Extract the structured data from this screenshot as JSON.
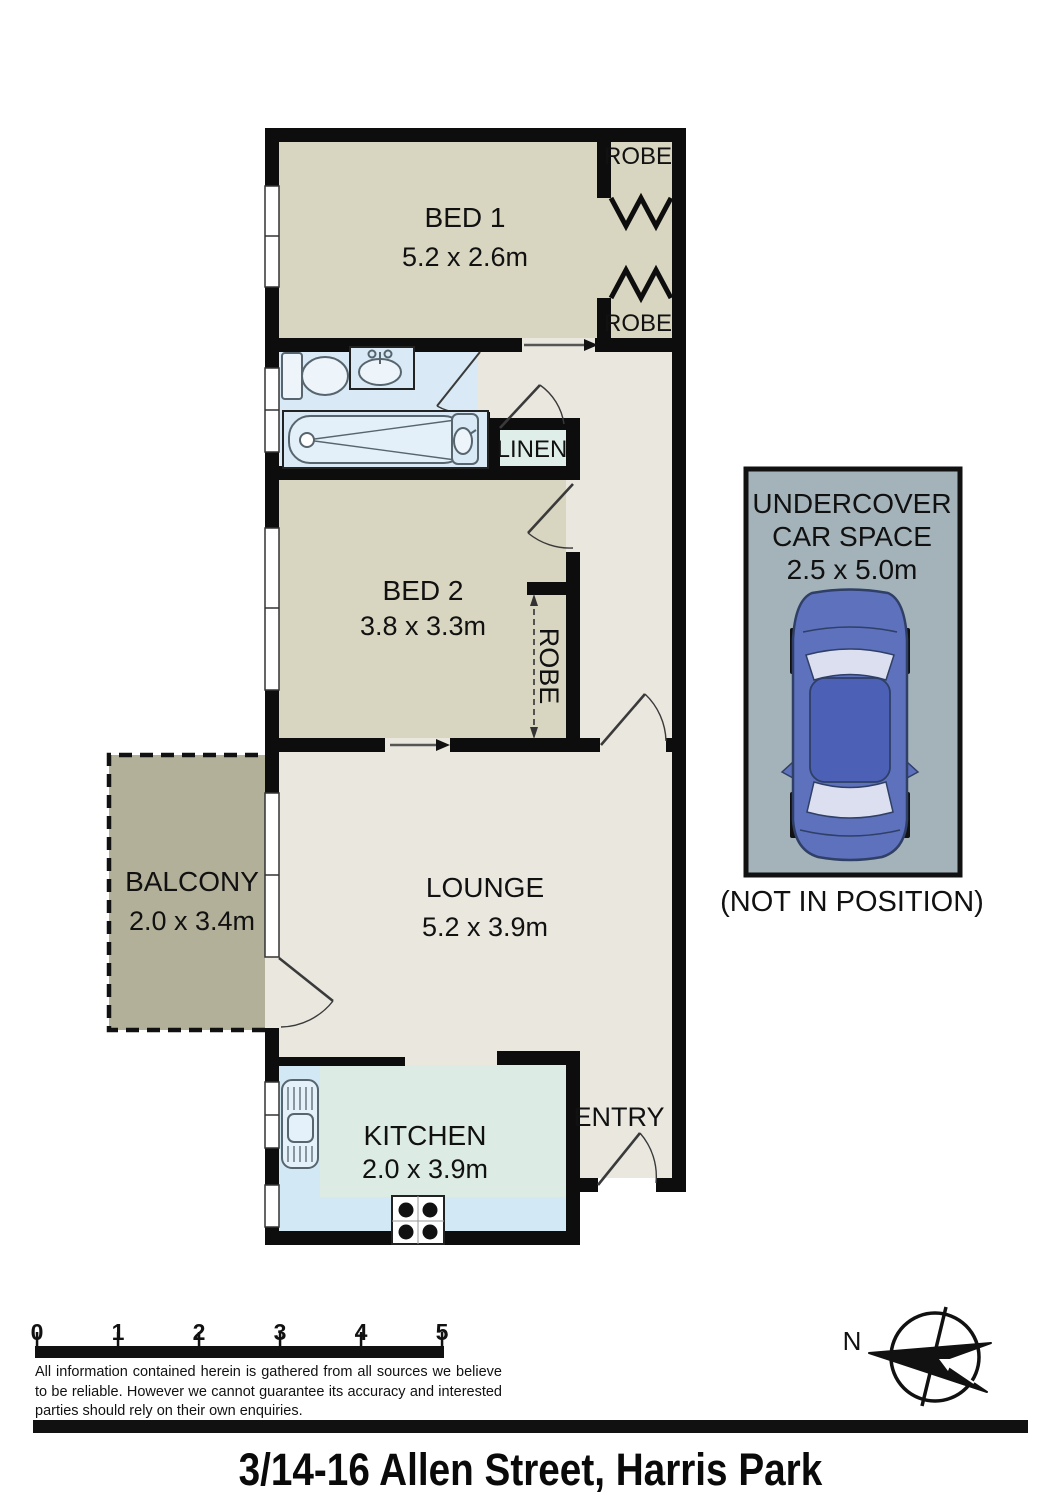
{
  "title": "3/14-16 Allen Street, Harris Park",
  "rooms": {
    "bed1": {
      "name": "BED 1",
      "dims": "5.2 x 2.6m"
    },
    "bed2": {
      "name": "BED 2",
      "dims": "3.8 x 3.3m"
    },
    "lounge": {
      "name": "LOUNGE",
      "dims": "5.2 x 3.9m"
    },
    "kitchen": {
      "name": "KITCHEN",
      "dims": "2.0 x 3.9m"
    },
    "balcony": {
      "name": "BALCONY",
      "dims": "2.0 x 3.4m"
    },
    "entry": {
      "name": "ENTRY"
    },
    "linen": {
      "name": "LINEN"
    },
    "robe1": {
      "name": "ROBE"
    },
    "robe2": {
      "name": "ROBE"
    },
    "robe3": {
      "name": "ROBE"
    }
  },
  "car_space": {
    "title_line1": "UNDERCOVER",
    "title_line2": "CAR SPACE",
    "dims": "2.5 x 5.0m",
    "note": "(NOT IN POSITION)"
  },
  "compass": {
    "north_label": "N"
  },
  "scale_bar": {
    "labels": [
      "0",
      "1",
      "2",
      "3",
      "4",
      "5"
    ]
  },
  "disclaimer": "All information contained herein is gathered from all sources we believe to be reliable. However we cannot guarantee its accuracy and interested parties should rely on their own enquiries.",
  "colors": {
    "wall": "#0d0d0d",
    "bed_fill": "#d8d5c0",
    "living_fill": "#eae7df",
    "bath_fill": "#d9eaf6",
    "kitchen_counter": "#d3e8f5",
    "kitchen_floor": "#dcebe3",
    "linen_fill": "#dfeee9",
    "balcony_fill": "#b3b099",
    "carspace_fill": "#a4b3b9",
    "car_body": "#5d71bd",
    "car_roof": "#4c61b6",
    "car_glass": "#dcdff0"
  }
}
